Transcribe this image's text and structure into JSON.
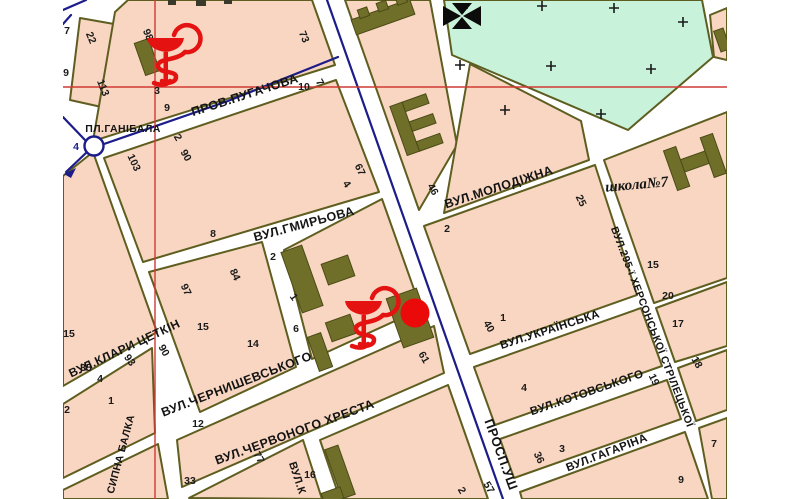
{
  "map": {
    "type": "city-street-map",
    "streets": [
      "ПРОВ.ПУГАЧОВА",
      "ВУЛ.ГМИРЬОВА",
      "ВУЛ.МОЛОДІЖНА",
      "ВУЛ.КЛАРИ ЦЕТКІН",
      "ВУЛ.ЧЕРНИШЕВСЬКОГО",
      "ВУЛ.ЧЕРВОНОГО ХРЕСТА",
      "ВУЛ.УКРАЇНСЬКА",
      "ВУЛ.КОТОВСЬКОГО",
      "ВУЛ.ГАГАРІНА",
      "ПРОСП.УШ",
      "ВУЛ.295-ї ХЕРСОНСЬКОЇ СТРІЛЕЦЬКОЇ",
      "СИПНА БАЛКА",
      "ВУЛ.К"
    ],
    "labels": {
      "square": "ПЛ.ГАНІБАЛА",
      "school": "школа№7"
    },
    "house_numbers": [
      "98",
      "3",
      "9",
      "73",
      "22",
      "113",
      "2",
      "90",
      "10",
      "7",
      "8",
      "4",
      "67",
      "103",
      "7",
      "9",
      "4",
      "97",
      "15",
      "35",
      "4",
      "1",
      "93",
      "90",
      "2",
      "15",
      "14",
      "6",
      "84",
      "2",
      "1",
      "12",
      "77",
      "33",
      "16",
      "61",
      "57",
      "2",
      "46",
      "2",
      "25",
      "40",
      "1",
      "4",
      "36",
      "3",
      "15",
      "20",
      "17",
      "18",
      "19",
      "9",
      "7"
    ],
    "symbols": {
      "pharmacy": "bowl-of-hygieia-icon",
      "church": "cross-pattee-icon",
      "marker": "red-dot-marker",
      "cemetery_mark": "plus-cross",
      "roundabout": "circle"
    },
    "colors": {
      "block_fill": "#f8d6c1",
      "block_border": "#5e5e20",
      "building": "#6f6f2a",
      "cemetery": "#c9f2da",
      "road_line": "#1c1c8a",
      "crosshair": "#cf3a33",
      "symbol_red": "#e51212",
      "street": "#ffffff"
    }
  }
}
